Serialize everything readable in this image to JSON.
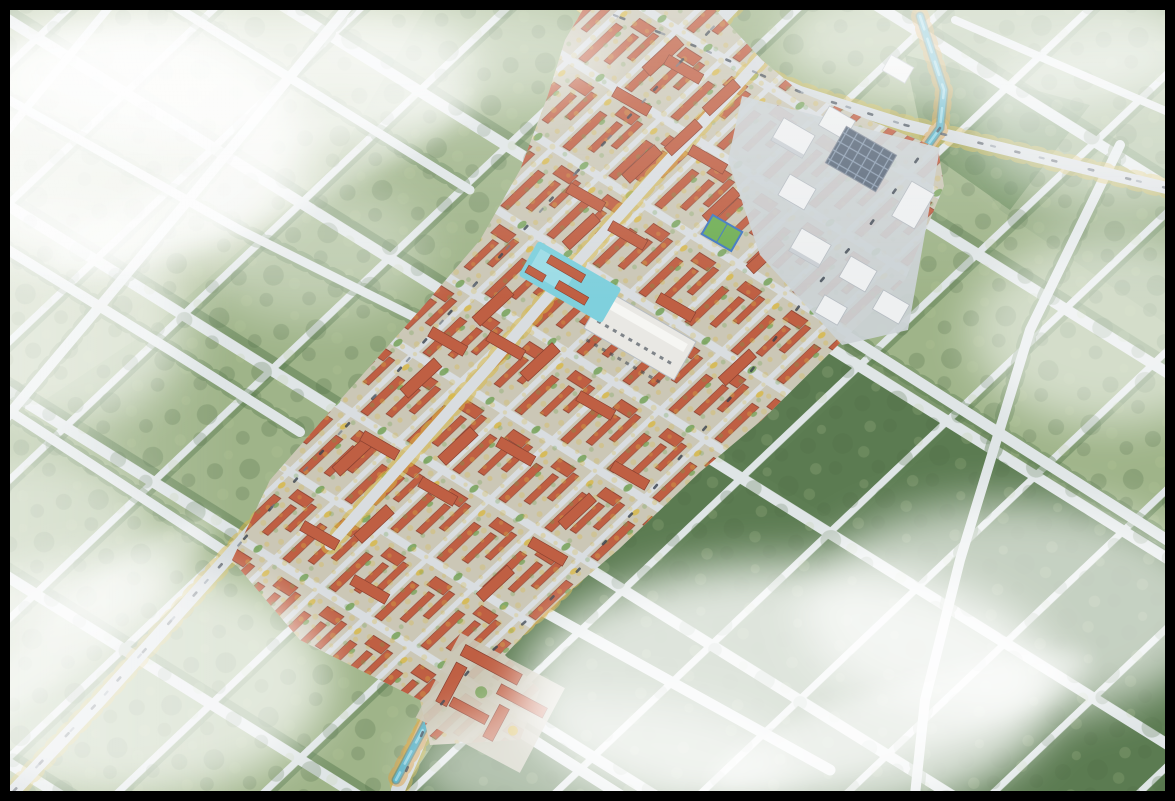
{
  "scene": {
    "type": "aerial-masterplan-rendering",
    "description": "High oblique bird's-eye architectural rendering of a planned town: a diagonal band of red-roofed low-rise residential blocks with tree-lined streets, a white office campus with a solar roof at the north-east, a swimming-pool courtyard, a sports court, a school complex at the south, all set in a rotated grid of rural roads and forest parcels with a winding tree-lined canal and drifting white fog.",
    "camera": "high oblique aerial view",
    "conditions": "daytime, hazy with low clouds"
  },
  "features": {
    "town": "red-roof residential district",
    "campus": "white office campus with solar roof",
    "pool": "outdoor swimming pool courtyard",
    "court": "basketball sports court",
    "school": "school complex with courtyards",
    "canal": "tree-lined winding canal",
    "forest": "forest parcel grid",
    "roads": "rural arterial road grid",
    "fog": "low drifting fog"
  },
  "palette": {
    "frame": "#000000",
    "forest-base": "#9fb489",
    "forest-pale": "#abbc93",
    "forest-topright": "#95ac82",
    "forest-dark": "#5b7b51",
    "forest-mid": "#6f8f60",
    "canopy": "#4e6b44",
    "canopy-light": "#b7c796",
    "road-rural": "#dfe5e6",
    "road-main": "#d4dadd",
    "road-town": "#d9dde0",
    "hedge": "#5e7f53",
    "gold": "#d8b845",
    "orange-tree": "#d89b3c",
    "ground-town": "#cbc7b6",
    "roof-red": "#bf5f43",
    "roof-dk": "#8a4030",
    "tree-town": "#6f9e4f",
    "pool": "#7fd0dd",
    "pool-light": "#a8e1ea",
    "water": "#58b0c4",
    "water-deep": "#2e7d96",
    "water-light": "#9fdbe8",
    "office-white": "#eef0f1",
    "office-shade": "#c2c8cd",
    "office-edge": "#b6bcc2",
    "solar": "#5d6b7c",
    "solar-line": "#8fa0b4",
    "campus-ground": "#ccd3d6",
    "commercial-white": "#e9e8e4",
    "court-green": "#6fae54",
    "court-blue": "#3f77c2",
    "car": "#39424e",
    "fog": "#ffffff"
  }
}
